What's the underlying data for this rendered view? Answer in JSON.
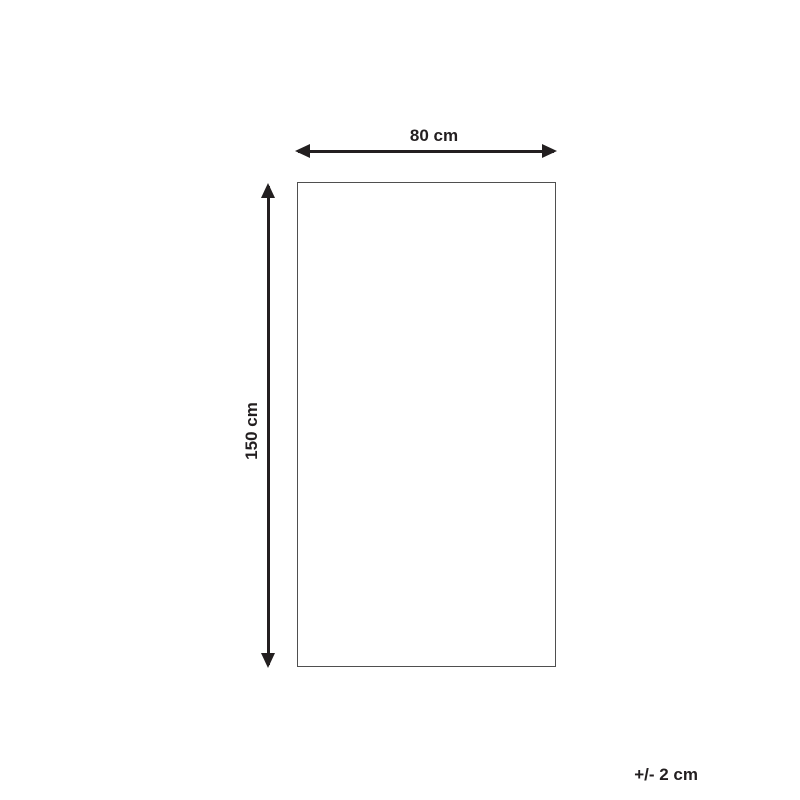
{
  "diagram": {
    "width_label": "80 cm",
    "height_label": "150 cm",
    "tolerance_label": "+/- 2 cm"
  },
  "colors": {
    "arrow": "#231f20",
    "text": "#231f20",
    "rect_border": "#4f4f4f",
    "background": "#ffffff"
  }
}
